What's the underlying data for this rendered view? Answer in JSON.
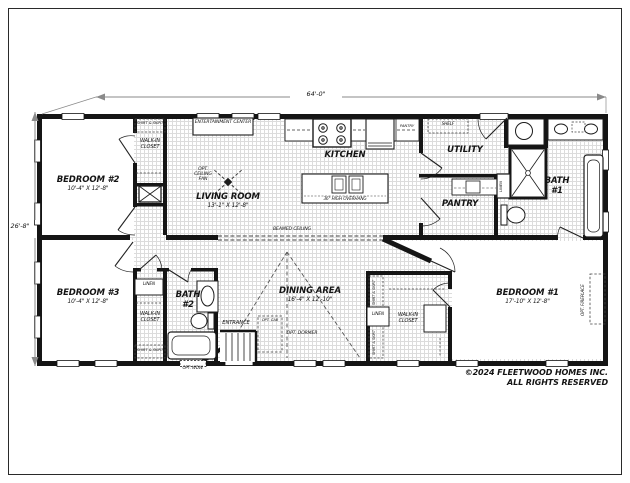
{
  "dimensions": {
    "width": "64'-0\"",
    "height": "26'-8\""
  },
  "rooms": {
    "bedroom2": {
      "name": "BEDROOM #2",
      "size": "10'-4\" X 12'-8\""
    },
    "bedroom3": {
      "name": "BEDROOM #3",
      "size": "10'-4\" X 12'-8\""
    },
    "bedroom1": {
      "name": "BEDROOM #1",
      "size": "17'-10\" X 12'-8\""
    },
    "living": {
      "name": "LIVING ROOM",
      "size": "13'-1\" X 12'-8\""
    },
    "dining": {
      "name": "DINING AREA",
      "size": "16'-4\" X 12'-10\""
    },
    "kitchen": {
      "name": "KITCHEN"
    },
    "utility": {
      "name": "UTILITY"
    },
    "pantry": {
      "name": "PANTRY"
    },
    "bath1": {
      "line1": "BATH",
      "line2": "#1"
    },
    "bath2": {
      "line1": "BATH",
      "line2": "#2"
    },
    "entrance": {
      "name": "ENTRANCE"
    }
  },
  "features": {
    "entertainment_center": "ENTERTAINMENT CENTER",
    "walk_in_closet": "WALK-IN CLOSET",
    "shirt_skirt": "SHIRT & SKIRT",
    "linen": "LINEN",
    "opt_ceiling_fan": "OPT. CEILING FAN",
    "overhang": "36\" HIGH OVERHANG",
    "beamed_ceiling": "BEAMED CEILING",
    "shelf": "SHELF",
    "pantry_cabinet": "PANTRY",
    "opt_cab": "OPT. CAB",
    "opt_dormer": "OPT. DORMER",
    "opt_wdw": "OPT. WDW.",
    "opt_fireplace": "OPT. FIREPLACE"
  },
  "copyright": {
    "line1": "©2024 FLEETWOOD HOMES INC.",
    "line2": "ALL RIGHTS RESERVED"
  }
}
